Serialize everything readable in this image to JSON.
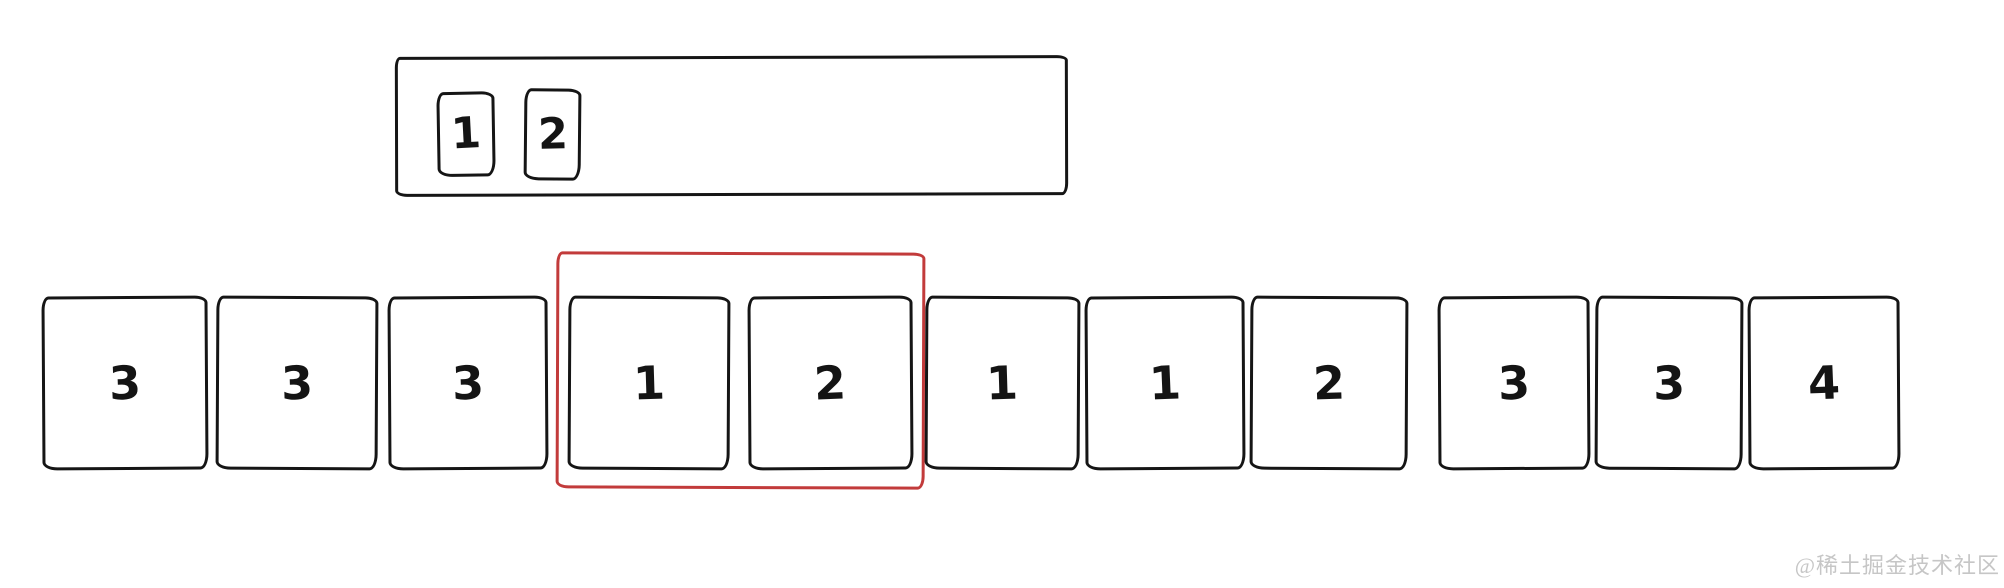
{
  "colors": {
    "ink": "#151515",
    "highlight_red": "#c23b3b",
    "watermark_gray": "#c6c6c6",
    "background": "#ffffff"
  },
  "pattern_window": {
    "cells": [
      {
        "value": "1"
      },
      {
        "value": "2"
      }
    ]
  },
  "array_row": {
    "cells": [
      {
        "value": "3"
      },
      {
        "value": "3"
      },
      {
        "value": "3"
      },
      {
        "value": "1"
      },
      {
        "value": "2"
      },
      {
        "value": "1"
      },
      {
        "value": "1"
      },
      {
        "value": "2"
      },
      {
        "value": "3"
      },
      {
        "value": "3"
      },
      {
        "value": "4"
      }
    ],
    "highlight": {
      "start_index": 3,
      "end_index": 4,
      "color": "#c23b3b"
    }
  },
  "watermark": {
    "text": "@稀土掘金技术社区"
  }
}
